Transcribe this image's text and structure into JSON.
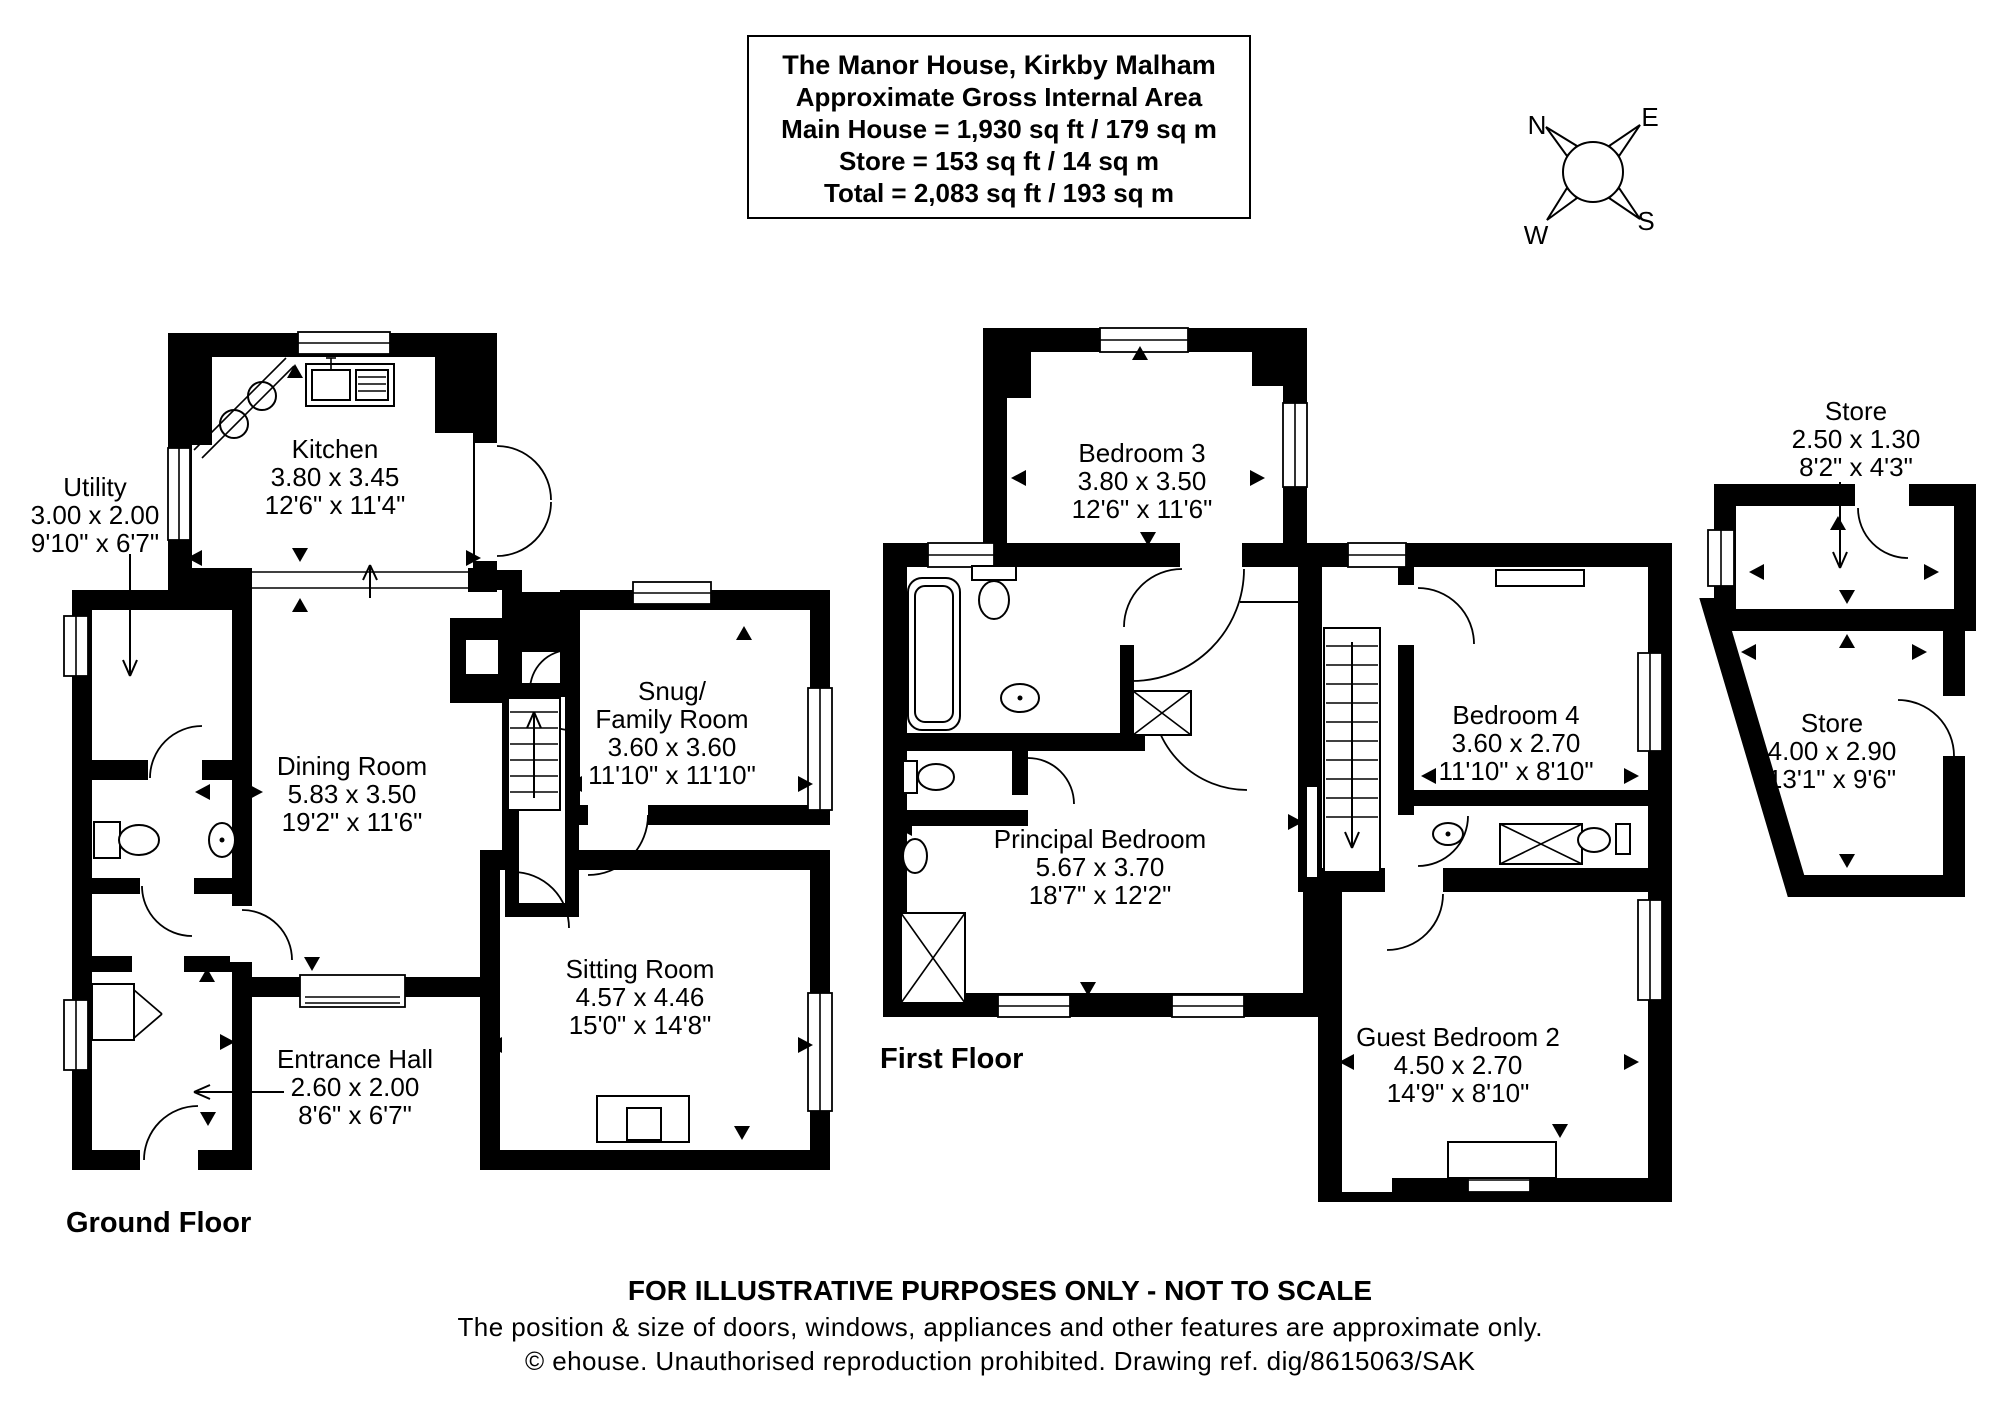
{
  "title_box": {
    "line1": "The Manor House, Kirkby Malham",
    "line2": "Approximate Gross Internal Area",
    "line3": "Main House = 1,930 sq ft / 179 sq m",
    "line4": "Store = 153 sq ft / 14 sq m",
    "line5": "Total = 2,083 sq ft / 193 sq m"
  },
  "compass": {
    "n": "N",
    "e": "E",
    "s": "S",
    "w": "W"
  },
  "floor_labels": {
    "ground": "Ground Floor",
    "first": "First Floor"
  },
  "rooms": {
    "kitchen": {
      "name": "Kitchen",
      "metric": "3.80 x 3.45",
      "imperial": "12'6\" x 11'4\""
    },
    "utility": {
      "name": "Utility",
      "metric": "3.00 x 2.00",
      "imperial": "9'10\" x 6'7\""
    },
    "dining": {
      "name": "Dining Room",
      "metric": "5.83 x 3.50",
      "imperial": "19'2\" x 11'6\""
    },
    "snug": {
      "name1": "Snug/",
      "name2": "Family Room",
      "metric": "3.60 x 3.60",
      "imperial": "11'10\" x 11'10\""
    },
    "sitting": {
      "name": "Sitting Room",
      "metric": "4.57 x 4.46",
      "imperial": "15'0\" x 14'8\""
    },
    "entrance": {
      "name": "Entrance Hall",
      "metric": "2.60 x 2.00",
      "imperial": "8'6\" x 6'7\""
    },
    "bedroom3": {
      "name": "Bedroom 3",
      "metric": "3.80 x 3.50",
      "imperial": "12'6\" x 11'6\""
    },
    "principal": {
      "name": "Principal Bedroom",
      "metric": "5.67 x 3.70",
      "imperial": "18'7\" x 12'2\""
    },
    "bedroom4": {
      "name": "Bedroom 4",
      "metric": "3.60 x 2.70",
      "imperial": "11'10\" x 8'10\""
    },
    "guest": {
      "name": "Guest Bedroom 2",
      "metric": "4.50 x 2.70",
      "imperial": "14'9\" x 8'10\""
    },
    "store1": {
      "name": "Store",
      "metric": "2.50 x 1.30",
      "imperial": "8'2\" x 4'3\""
    },
    "store2": {
      "name": "Store",
      "metric": "4.00 x 2.90",
      "imperial": "13'1\" x 9'6\""
    }
  },
  "footer": {
    "line1": "FOR ILLUSTRATIVE PURPOSES ONLY - NOT TO SCALE",
    "line2": "The position & size of doors, windows, appliances and other features are approximate only.",
    "line3": "© ehouse. Unauthorised reproduction prohibited. Drawing ref. dig/8615063/SAK"
  },
  "colors": {
    "walls": "#000000",
    "background": "#ffffff"
  }
}
